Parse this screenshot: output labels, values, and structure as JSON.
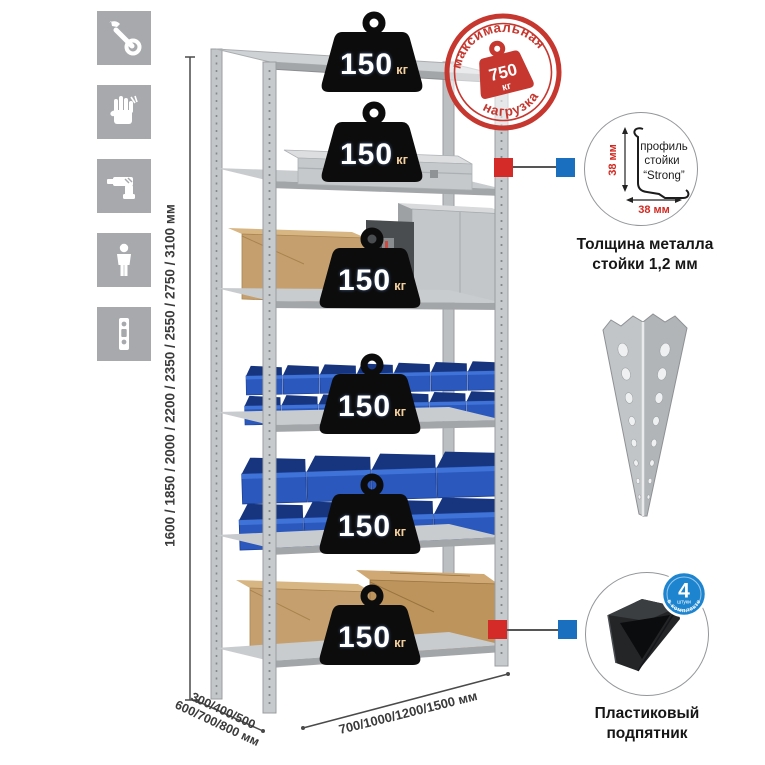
{
  "left_icons": [
    "wrench-icon",
    "gloves-icon",
    "drill-icon",
    "person-icon",
    "rack-post-icon"
  ],
  "dimensions": {
    "height_label": "1600 / 1850 / 2000 / 2200 / 2350 / 2550 / 2750 / 3100 мм",
    "depth_label_line1": "300/400/500",
    "depth_label_line2": "600/700/800 мм",
    "width_label": "700/1000/1200/1500 мм"
  },
  "weights": [
    {
      "value": "150",
      "unit": "кг"
    },
    {
      "value": "150",
      "unit": "кг"
    },
    {
      "value": "150",
      "unit": "кг"
    },
    {
      "value": "150",
      "unit": "кг"
    },
    {
      "value": "150",
      "unit": "кг"
    },
    {
      "value": "150",
      "unit": "кг"
    }
  ],
  "max_load_stamp": {
    "arc_top": "максимальная",
    "arc_bottom": "нагрузка",
    "value": "750",
    "unit": "кг"
  },
  "profile_detail": {
    "label_line1": "профиль",
    "label_line2": "стойки",
    "label_line3": "“Strong”",
    "vertical_dim": "38 мм",
    "horizontal_dim": "38 мм",
    "caption_line1": "Толщина металла",
    "caption_line2": "стойки 1,2 мм"
  },
  "foot_detail": {
    "badge_number": "4",
    "badge_word": "штуки",
    "badge_arc": "в комплекте",
    "caption_line1": "Пластиковый",
    "caption_line2": "подпятник"
  },
  "colors": {
    "stamp_red": "#c5372f",
    "marker_red": "#d42a28",
    "marker_blue": "#1a6fbf",
    "badge_blue": "#1d84cf",
    "bin_blue": "#2a58bd",
    "weight_black": "#0c0c0c",
    "icon_gray": "#a7a9ac",
    "metal_light": "#c9ccce",
    "metal_dark": "#9b9ea1",
    "cardboard": "#c5a06e",
    "dim_text": "#3a3a3a",
    "dim_red": "#d02b22"
  }
}
